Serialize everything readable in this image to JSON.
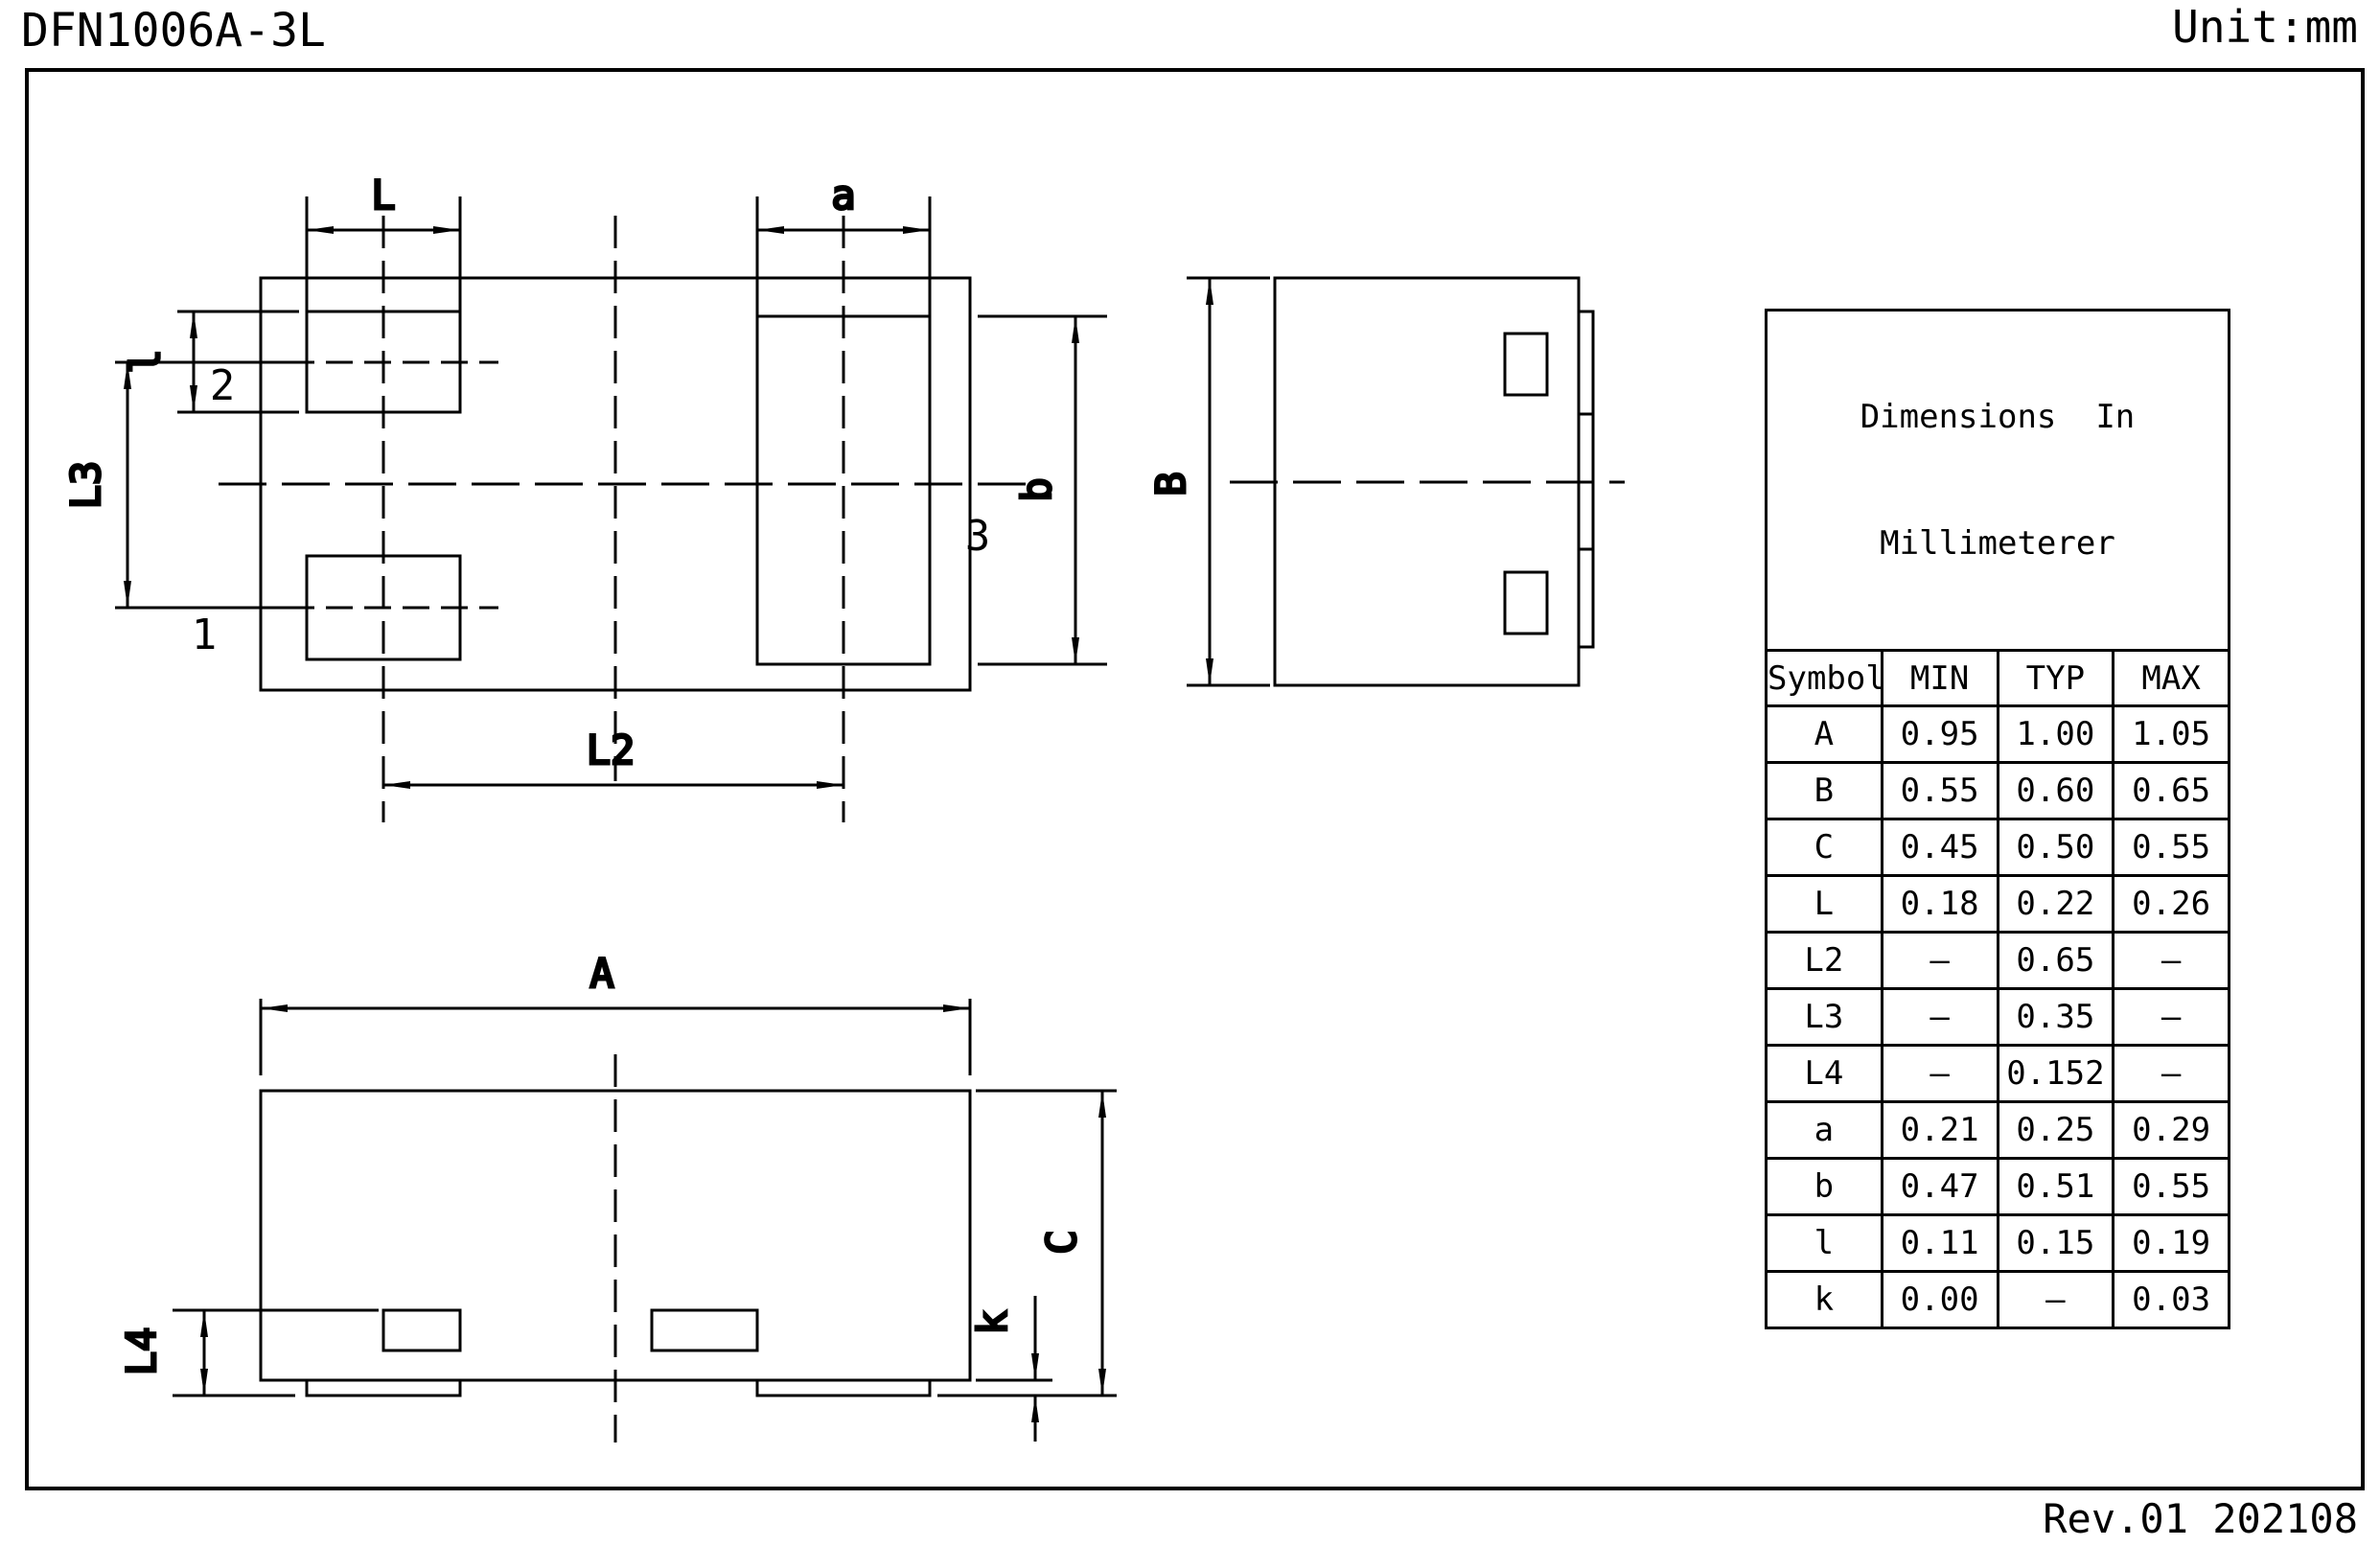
{
  "header": {
    "title": "DFN1006A-3L",
    "unit": "Unit:mm"
  },
  "footer": {
    "revision": "Rev.01  202108"
  },
  "colors": {
    "ink": "#000000",
    "paper": "#ffffff"
  },
  "views": {
    "top": {
      "dim_L": "L",
      "dim_a": "a",
      "dim_l": "l",
      "dim_L3": "L3",
      "dim_L2": "L2",
      "dim_b": "b",
      "pin1": "1",
      "pin2": "2",
      "pin3": "3"
    },
    "side": {
      "dim_B": "B"
    },
    "front": {
      "dim_A": "A",
      "dim_L4": "L4",
      "dim_k": "k",
      "dim_C": "C"
    }
  },
  "table": {
    "title_line1": "Dimensions  In",
    "title_line2": "Millimeterer",
    "headers": [
      "Symbol",
      "MIN",
      "TYP",
      "MAX"
    ],
    "rows": [
      {
        "symbol": "A",
        "min": "0.95",
        "typ": "1.00",
        "max": "1.05"
      },
      {
        "symbol": "B",
        "min": "0.55",
        "typ": "0.60",
        "max": "0.65"
      },
      {
        "symbol": "C",
        "min": "0.45",
        "typ": "0.50",
        "max": "0.55"
      },
      {
        "symbol": "L",
        "min": "0.18",
        "typ": "0.22",
        "max": "0.26"
      },
      {
        "symbol": "L2",
        "min": "–",
        "typ": "0.65",
        "max": "–"
      },
      {
        "symbol": "L3",
        "min": "–",
        "typ": "0.35",
        "max": "–"
      },
      {
        "symbol": "L4",
        "min": "–",
        "typ": "0.152",
        "max": "–"
      },
      {
        "symbol": "a",
        "min": "0.21",
        "typ": "0.25",
        "max": "0.29"
      },
      {
        "symbol": "b",
        "min": "0.47",
        "typ": "0.51",
        "max": "0.55"
      },
      {
        "symbol": "l",
        "min": "0.11",
        "typ": "0.15",
        "max": "0.19"
      },
      {
        "symbol": "k",
        "min": "0.00",
        "typ": "–",
        "max": "0.03"
      }
    ]
  }
}
